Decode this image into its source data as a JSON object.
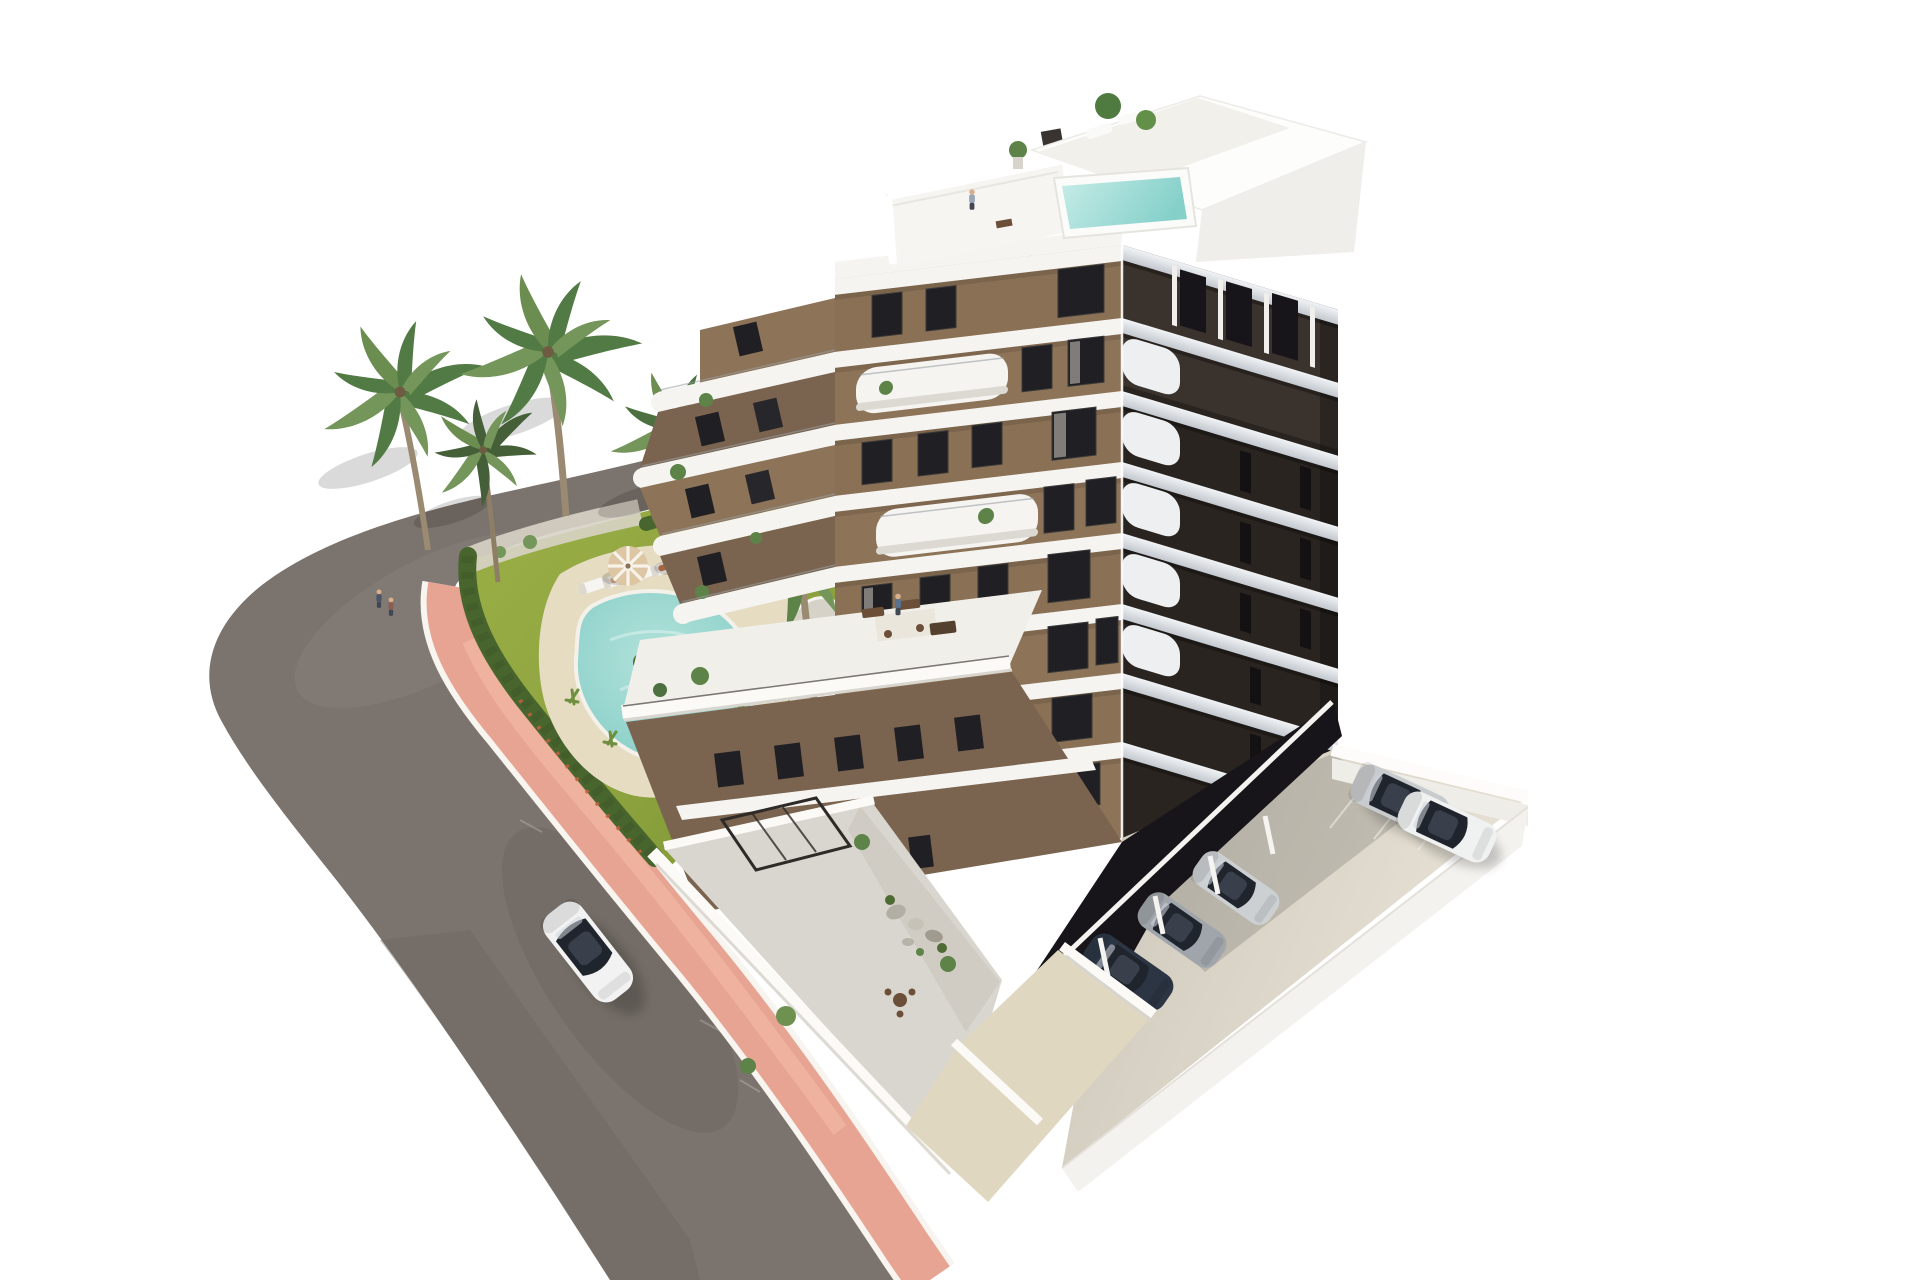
{
  "scene": {
    "type": "aerial 3d architectural render",
    "subject": "modern 8-storey apartment building with curved white balconies, garden pool and parking",
    "lighting": "bright daylight, white background",
    "building": {
      "floors_visible": 8,
      "balcony_style": "rounded white bands",
      "rooftop": {
        "plunge_pool": true,
        "terrace_people": 1,
        "plants": 3
      },
      "people_on_balconies": 3
    },
    "garden": {
      "pool_shape": "freeform kidney",
      "sun_loungers": 5,
      "umbrellas": 2,
      "palm_trees": 5,
      "people": 6,
      "hedge_along_sidewalk": true
    },
    "street": {
      "moving_cars": 1,
      "moving_car_color_name": "white",
      "sidewalk_color_name": "salmon pink",
      "curb_lines": 2
    },
    "parking": {
      "open_lot_cars": 2,
      "open_lot_car_colors": [
        "silver",
        "white"
      ],
      "covered_cars": 4,
      "driveway": true,
      "perimeter_wall": "white"
    }
  },
  "colors": {
    "bg": "#ffffff",
    "road": "#7b736d",
    "road_dark": "#6e6660",
    "sidewalk": "#e8a492",
    "curb": "#f8f5f1",
    "lawn": "#8ca23e",
    "lawn_light": "#a9bb50",
    "hedge": "#49652e",
    "gravel": "#d8d3c7",
    "deck": "#e6dcc2",
    "pool_light": "#bfe8e1",
    "pool_deep": "#68c1bd",
    "pool_rim": "#f4f1ea",
    "facade": "#8d7458",
    "facade_dark": "#7a6450",
    "band": "#f5f4f0",
    "window": "#1f1f24",
    "right_wall": "#2a2420",
    "right_band": "#e9ebee",
    "concrete": "#d8d2c5",
    "concrete_light": "#e7e2d5",
    "garage": "#18151a",
    "driveway": "#e0d7c0",
    "wall_white": "#fbfaf7",
    "terrace_floor": "#d9d6cf",
    "car_white": "#f2f2f2",
    "car_silver": "#c8cbcd",
    "car_navy": "#232c39",
    "trunk": "#9b8a72",
    "palm": "#527a44",
    "palm_light": "#74965a",
    "palm_dark": "#455f38",
    "umbrella": "#dcc6a4",
    "furniture": "#6b4f39"
  }
}
